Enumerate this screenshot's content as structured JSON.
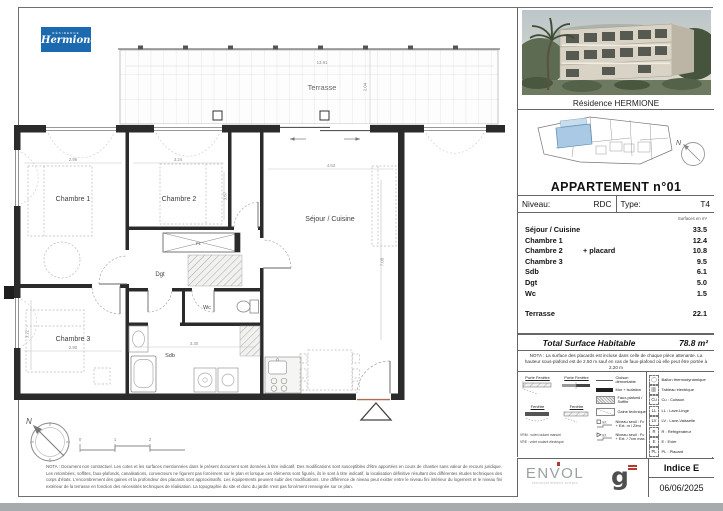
{
  "brand": {
    "residence_label": "RÉSIDENCE",
    "name": "Hermione"
  },
  "colors": {
    "brand_blue": "#1b69ae",
    "unit_highlight": "#a9c9e4",
    "wall": "#2b2b2b",
    "accent_red": "#b23b2e"
  },
  "panel": {
    "photo_caption": "Résidence HERMIONE",
    "apartment_title": "APPARTEMENT n°01",
    "niveau_label": "Niveau:",
    "niveau_value": "RDC",
    "type_label": "Type:",
    "type_value": "T4",
    "surfaces_unit": "Surfaces en m²",
    "rows": [
      {
        "label": "Séjour / Cuisine",
        "extra": "",
        "value": "33.5"
      },
      {
        "label": "Chambre 1",
        "extra": "",
        "value": "12.4"
      },
      {
        "label": "Chambre 2",
        "extra": "+ placard",
        "value": "10.8"
      },
      {
        "label": "Chambre 3",
        "extra": "",
        "value": "9.5"
      },
      {
        "label": "Sdb",
        "extra": "",
        "value": "6.1"
      },
      {
        "label": "Dgt",
        "extra": "",
        "value": "5.0"
      },
      {
        "label": "Wc",
        "extra": "",
        "value": "1.5"
      }
    ],
    "terrasse_row": {
      "label": "Terrasse",
      "value": "22.1"
    },
    "total_label": "Total Surface Habitable",
    "total_value": "78.8",
    "total_unit": "m²",
    "nota": "NOTA : La surface des placards est incluse dans celle de chaque pièce attenante. La hauteur sous-plafond est de 2.50 m sauf en cas de faux-plafond où elle peut être portée à 2.20 m"
  },
  "plan": {
    "terrasse": "Terrasse",
    "chambre1": "Chambre 1",
    "chambre2": "Chambre 2",
    "sejour": "Séjour / Cuisine",
    "chambre3": "Chambre 3",
    "dgt": "Dgt",
    "wc": "Wc",
    "sdb": "Sdb",
    "pl": "PL",
    "dim_terrasse_w": "13.91",
    "dim_terrasse_d": "2.04",
    "dim_ch1_w": "2.96",
    "dim_ch2_w": "3.24",
    "dim_ch2_d": "3.67",
    "dim_sejour_w": "4.53",
    "dim_sejour_d": "7.08",
    "dim_ch3_w": "2.90",
    "dim_ch3_d": "3.22",
    "dim_sdb_w": "3.30",
    "north": "N",
    "scale": [
      "0",
      "1",
      "2"
    ]
  },
  "legend": {
    "pf1": "Porte Fenêtre",
    "pf2": "Porte Fenêtre",
    "f1": "Fenêtre",
    "f2": "Fenêtre",
    "vrm": "VRM : volet roulant manuel",
    "vre": "VRE : volet roulant électrique",
    "cloison": "Cloison démontable",
    "mur": "Mur + isolation",
    "faux_plafond": "Faux-plafond / Soffite",
    "gaine": "Gaine technique",
    "ref": "réf.",
    "seuil1": "Niveau seuil : Fc + Ext. m / Zéro",
    "seuil2": "Niveau seuil : Fc + Ext. / 7cm max.",
    "equip": [
      {
        "abbr": "",
        "label": "Ballon thermodynamique"
      },
      {
        "abbr": "",
        "label": "Tableau électrique"
      },
      {
        "abbr": "Cu",
        "label": "Cu : Cuisson"
      },
      {
        "abbr": "LL",
        "label": "LL : Lave-Linge"
      },
      {
        "abbr": "LV",
        "label": "LV : Lave-Vaisselle"
      },
      {
        "abbr": "R",
        "label": "R : Réfrigérateur"
      },
      {
        "abbr": "E",
        "label": "E : Evier"
      },
      {
        "abbr": "PL",
        "label": "PL : Placard"
      }
    ]
  },
  "footer": {
    "disclaimer": "NOTA : Document non contractuel. Les cotes et les surfaces mentionnées dans le présent document sont données à titre indicatif. Des modifications sont susceptibles d'être apportées en cours de chantier sans valeur de recours juridique. Les retombées, soffites, faux-plafonds, canalisations, convecteurs ne figurent pas forcément sur le plan et lorsque ces éléments sont figurés, ils le sont à titre indicatif, la localisation définitive résultant des différentes études techniques des corps d'états. L'encombrement des gaines et la profondeur des placards sont approximatifs. Les équipements peuvent subir des modifications. Une différence de niveau peut exister entre le niveau fini intérieur du logement et le niveau fini extérieur de la terrasse en fonction des nécessités techniques de réalisation. La topographie du site et donc du jardin n'est pas forcément renseignée sur ce plan.",
    "envol_name": "ENVOL",
    "envol_tagline": "renouvellement urbain",
    "g_letter": "g",
    "indice": "Indice E",
    "date": "06/06/2025"
  }
}
